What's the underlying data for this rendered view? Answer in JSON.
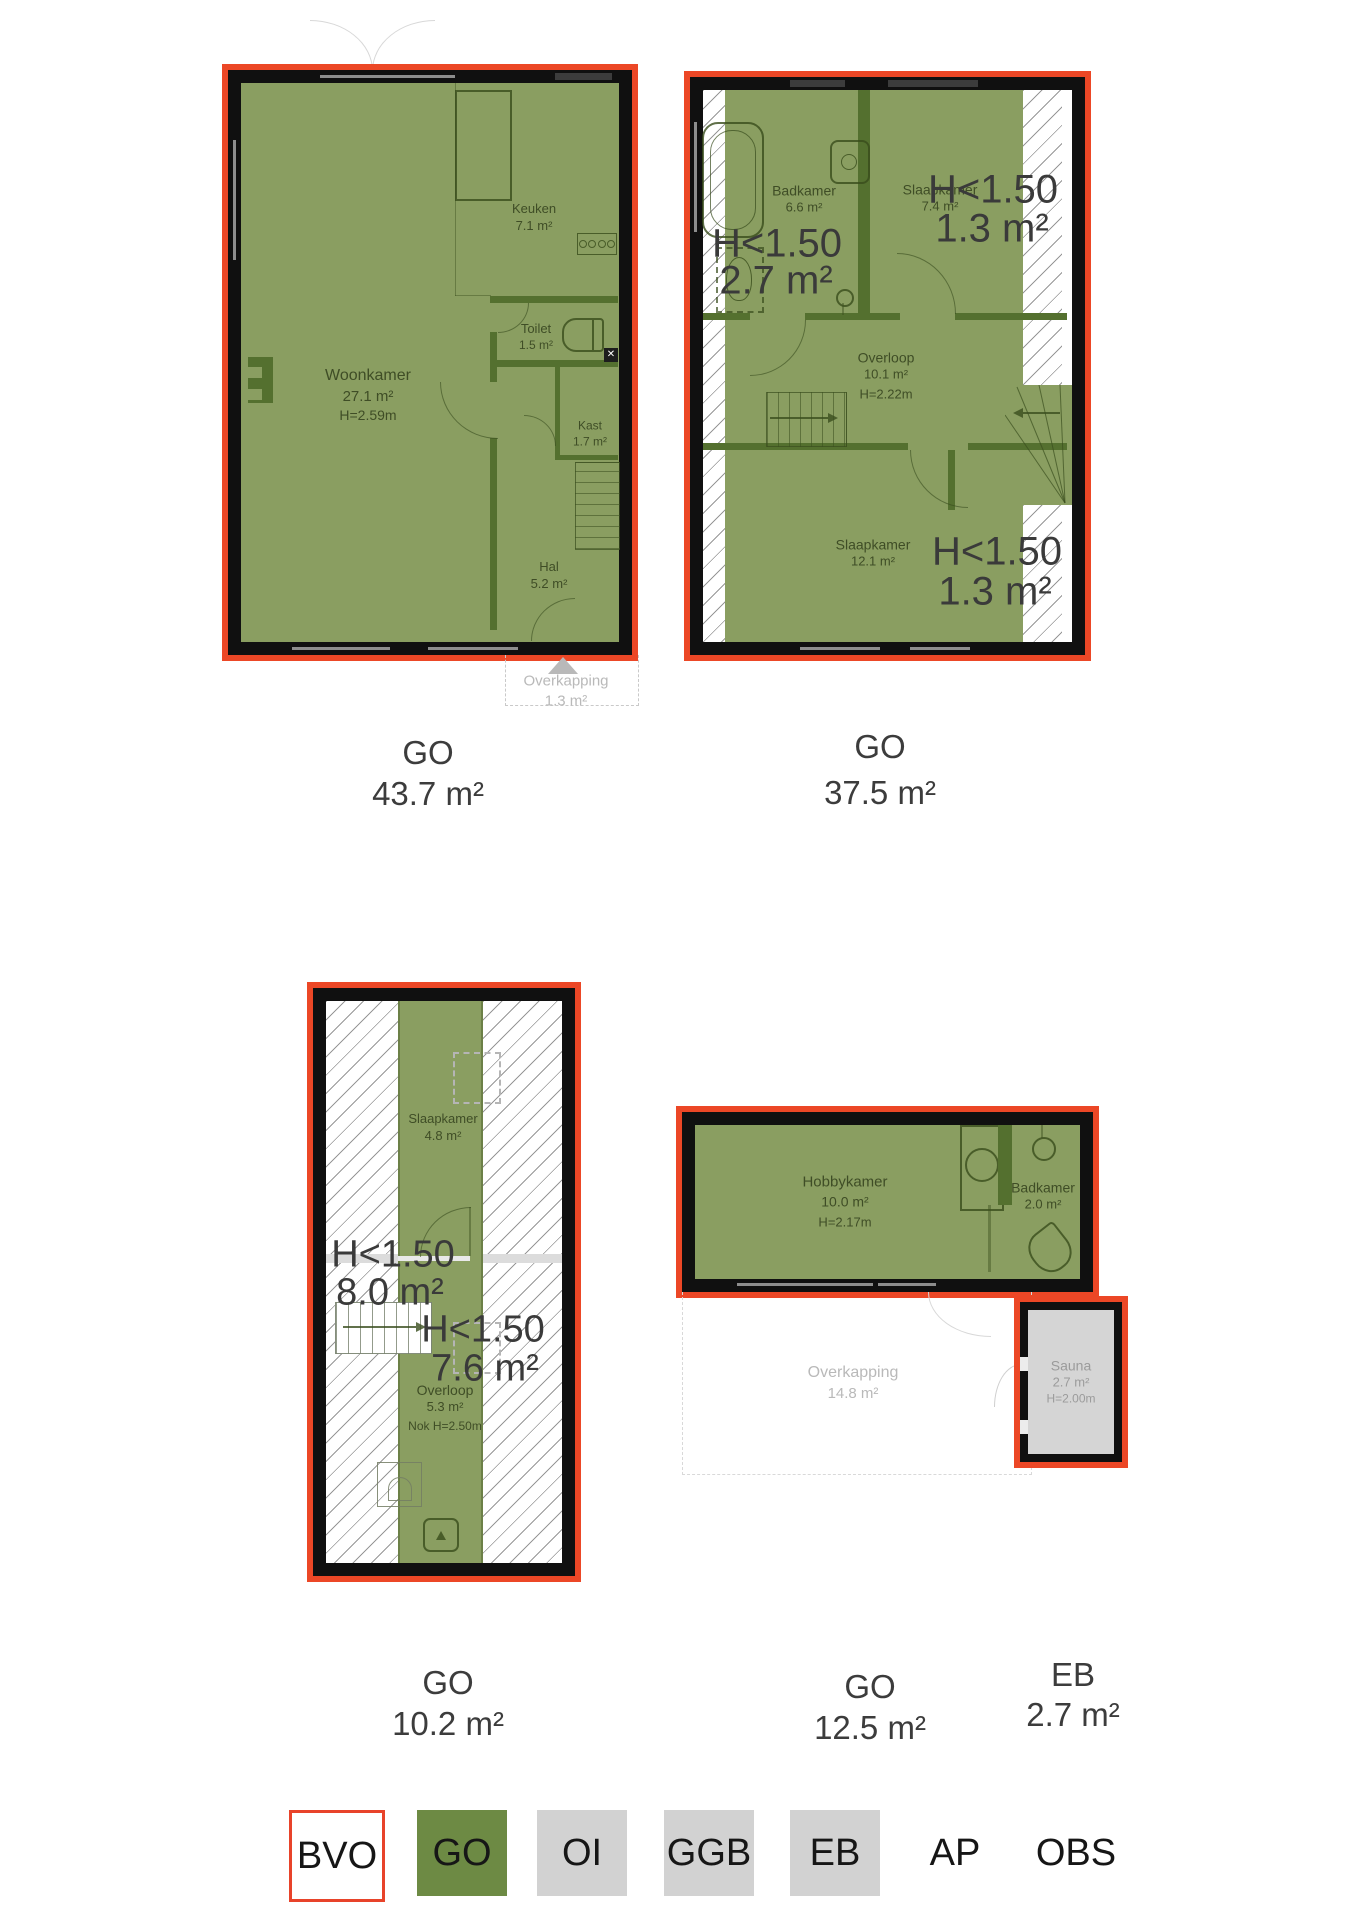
{
  "colors": {
    "bvo_outline_red": "#ec4726",
    "go_fill_green": "#8a9e61",
    "legend_green": "#6d8a44",
    "legend_gray": "#d2d2d2",
    "wall_black": "#101010",
    "interior_wall_green": "#54702f",
    "sauna_gray": "#d5d5d5"
  },
  "plan1": {
    "rooms": {
      "keuken": {
        "name": "Keuken",
        "area": "7.1 m²"
      },
      "woonkamer": {
        "name": "Woonkamer",
        "area": "27.1 m²",
        "height": "H=2.59m"
      },
      "toilet": {
        "name": "Toilet",
        "area": "1.5 m²"
      },
      "kast": {
        "name": "Kast",
        "area": "1.7 m²"
      },
      "hal": {
        "name": "Hal",
        "area": "5.2 m²"
      }
    },
    "overkapping": {
      "name": "Overkapping",
      "area": "1.3 m²"
    },
    "footer": {
      "label": "GO",
      "area": "43.7 m²"
    }
  },
  "plan2": {
    "rooms": {
      "badkamer": {
        "name": "Badkamer",
        "area": "6.6 m²"
      },
      "slaapkamer_top": {
        "name": "Slaapkamer",
        "area": "7.4 m²"
      },
      "overloop": {
        "name": "Overloop",
        "area": "10.1 m²",
        "height": "H=2.22m"
      },
      "slaapkamer_bottom": {
        "name": "Slaapkamer",
        "area": "12.1 m²"
      }
    },
    "h_labels": {
      "badkamer": {
        "line1": "H<1.50",
        "line2": "2.7 m²"
      },
      "slaapkamer_top": {
        "line1": "H<1.50",
        "line2": "1.3 m²"
      },
      "slaapkamer_bottom": {
        "line1": "H<1.50",
        "line2": "1.3 m²"
      }
    },
    "footer": {
      "label": "GO",
      "area": "37.5 m²"
    }
  },
  "plan3": {
    "rooms": {
      "slaapkamer": {
        "name": "Slaapkamer",
        "area": "4.8 m²"
      },
      "overloop": {
        "name": "Overloop",
        "area": "5.3 m²",
        "height": "Nok H=2.50m"
      }
    },
    "h_labels": {
      "left": {
        "line1": "H<1.50",
        "line2": "8.0 m²"
      },
      "right": {
        "line1": "H<1.50",
        "line2": "7.6 m²"
      }
    },
    "footer": {
      "label": "GO",
      "area": "10.2 m²"
    }
  },
  "plan4": {
    "rooms": {
      "hobbykamer": {
        "name": "Hobbykamer",
        "area": "10.0 m²",
        "height": "H=2.17m"
      },
      "badkamer": {
        "name": "Badkamer",
        "area": "2.0 m²"
      },
      "overkapping": {
        "name": "Overkapping",
        "area": "14.8 m²"
      },
      "sauna": {
        "name": "Sauna",
        "area": "2.7 m²",
        "height": "H=2.00m"
      }
    },
    "footer": {
      "label": "GO",
      "area": "12.5 m²"
    },
    "sauna_footer": {
      "label": "EB",
      "area": "2.7 m²"
    }
  },
  "legend": {
    "bvo": "BVO",
    "go": "GO",
    "oi": "OI",
    "ggb": "GGB",
    "eb": "EB",
    "ap": "AP",
    "obs": "OBS"
  }
}
